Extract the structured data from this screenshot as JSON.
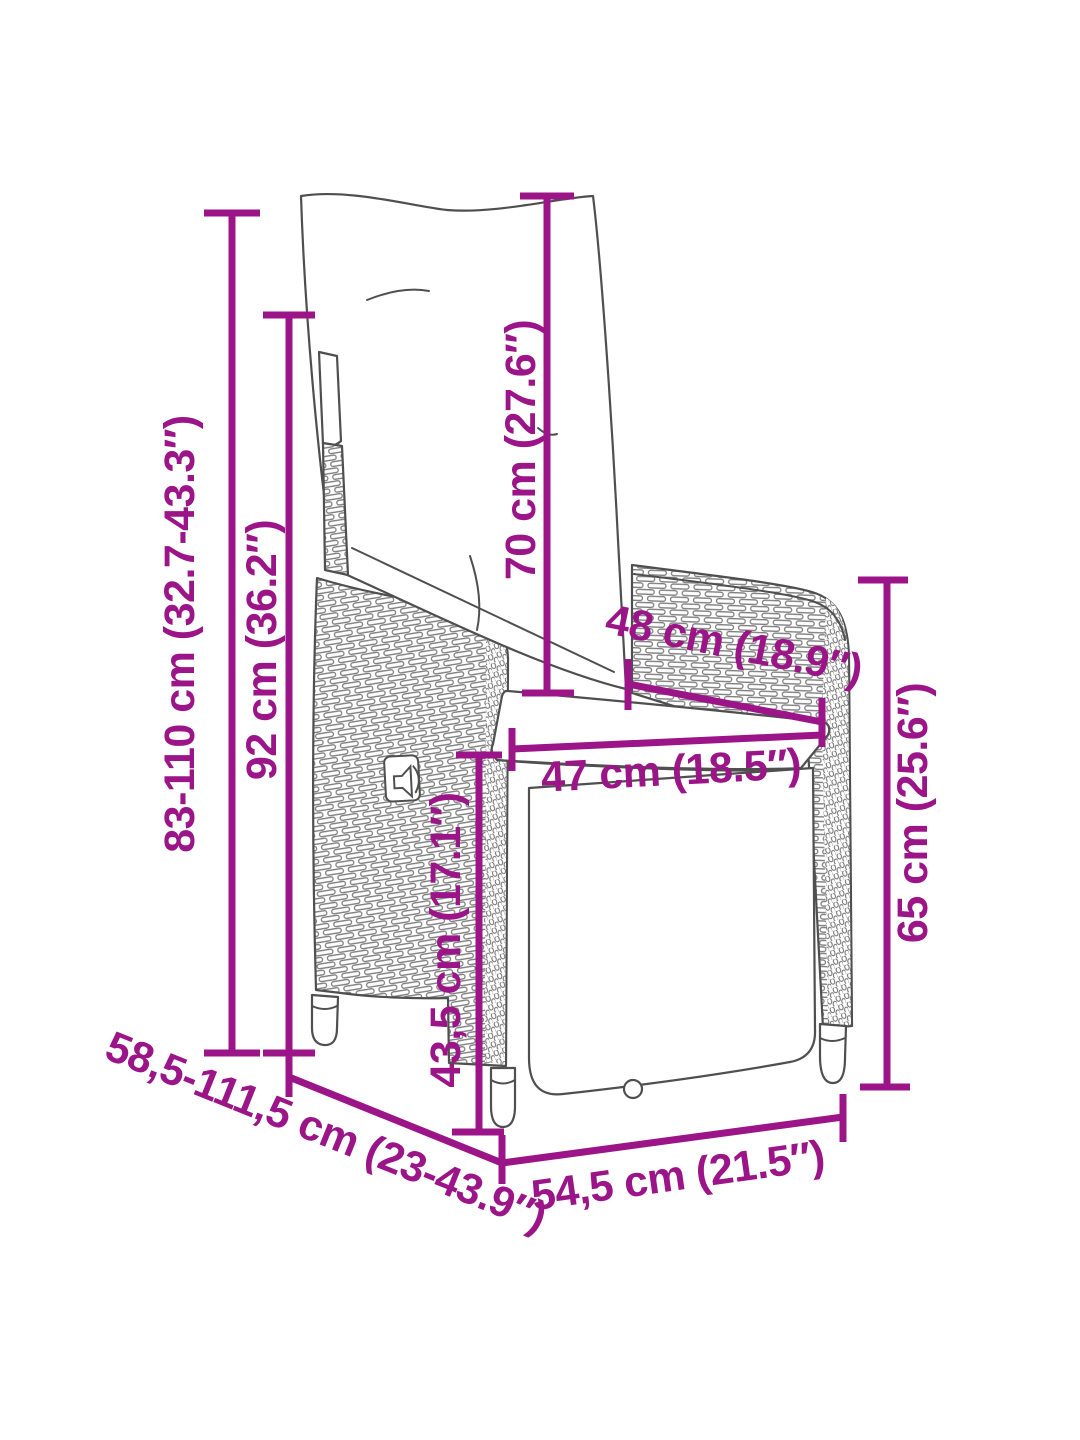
{
  "theme": {
    "accent": "#9B1588",
    "line": "#4F4F4F",
    "weave": "#7E7E7E",
    "background": "#FFFFFF"
  },
  "diagram": {
    "subject": "reclining-garden-chair-dimension-drawing",
    "dimensions": {
      "total_height": "83-110 cm (32.7-43.3″)",
      "backrest_height": "92 cm (36.2″)",
      "back_cushion_length": "70 cm (27.6″)",
      "armrest_span": "48 cm (18.9″)",
      "seat_width": "47 cm (18.5″)",
      "armrest_height": "65 cm (25.6″)",
      "seat_height": "43,5 cm (17.1″)",
      "total_depth": "58,5-111,5 cm (23-43.9″)",
      "base_depth": "54,5 cm (21.5″)"
    }
  }
}
